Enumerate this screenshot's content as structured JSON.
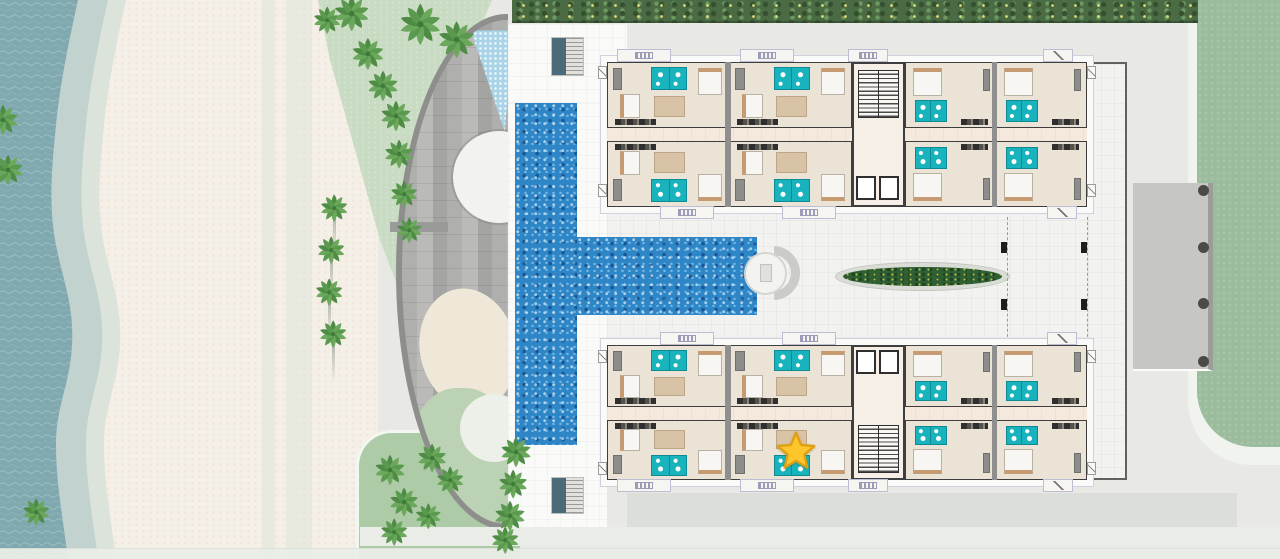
{
  "meta": {
    "description": "Aerial resort site / residential floor plan with beach, T-shaped pool, two apartment wings and a selected-unit star marker",
    "visible_text": []
  },
  "palette": {
    "ocean": "#7FA8AF",
    "foam": "#C2D2CE",
    "wet_sand": "#DCE3DB",
    "sand": "#F4EFE7",
    "lawn_pale": "#C9DCC3",
    "lawn_mid": "#AECBA8",
    "lawn_right": "#9CBD9D",
    "hedge": "#4A6B44",
    "paving": "#E8E9E5",
    "deck": "#FAFAF8",
    "courtyard": "#F2F2F0",
    "pool": "#2E86C6",
    "kids_pool": "#A9D4E8",
    "wall": "#3E3E3E",
    "unit_floor": "#EAE3D6",
    "corridor": "#F4E9DC",
    "bathroom_teal": "#18B3BC",
    "planter_green": "#2F5F33",
    "star_fill": "#FFC62B",
    "star_stroke": "#DFA012",
    "amenity_gray": "#AFAFAD"
  },
  "scene": {
    "beach": {
      "rect": [
        0,
        0,
        378,
        559
      ],
      "paths": [
        [
          262,
          0,
          13,
          559
        ],
        [
          286,
          0,
          26,
          559
        ]
      ]
    },
    "ocean": {
      "svg_w": 200,
      "wet": "M0,0 L126,0 C116,45 108,85 104,125 C100,165 96,205 104,245 C112,285 122,305 120,345 C118,385 104,405 104,445 C104,485 112,525 116,559 L0,559 Z",
      "foam": "M0,0 L108,0 C98,45 90,85 86,125 C82,165 78,205 86,245 C94,285 104,305 102,345 C100,385 86,405 86,445 C86,485 94,525 98,559 L0,559 Z",
      "water": "M0,0 L78,0 C68,45 60,85 56,125 C52,165 48,205 56,245 C64,285 74,305 72,345 C70,385 56,405 56,445 C56,485 64,525 68,559 L0,559 Z"
    },
    "lawn_top_left": {
      "rect": [
        300,
        0,
        210,
        300
      ],
      "clip": "polygon(18px 0px,192px 0px,180px 28px,145px 95px,120px 170px,105px 235px,99px 290px,80px 240px,55px 150px,30px 60px)"
    },
    "lawn_bottom_left": {
      "rect": [
        356,
        430,
        164,
        129
      ],
      "radius": "36px 0 0 0"
    },
    "lawn_right": {
      "outer": [
        1188,
        -40,
        132,
        505
      ],
      "outer_radius": "0 0 0 64px",
      "inner": [
        1197,
        -40,
        123,
        487
      ],
      "inner_radius": "0 0 0 56px"
    },
    "entry_pad": {
      "rect": [
        1133,
        183,
        80,
        188
      ],
      "dots": [
        [
          1198,
          185,
          11,
          11
        ],
        [
          1198,
          242,
          11,
          11
        ],
        [
          1198,
          298,
          11,
          11
        ],
        [
          1198,
          356,
          11,
          11
        ]
      ]
    },
    "hedge": {
      "rect": [
        512,
        0,
        686,
        23
      ]
    },
    "amenity": {
      "lens": [
        396,
        14,
        112,
        516
      ],
      "kids_pool": [
        66,
        6,
        46,
        108
      ],
      "shade_circle": [
        51,
        111,
        92,
        92
      ],
      "sand_patch": [
        18,
        268,
        96,
        122
      ],
      "green_patch": [
        6,
        368,
        106,
        148
      ],
      "pale_circle": [
        58,
        374,
        68,
        68
      ],
      "gray_bar": [
        390,
        222,
        58,
        10
      ]
    },
    "deck_rects": [
      [
        508,
        24,
        119,
        86
      ],
      [
        508,
        103,
        99,
        427
      ]
    ],
    "courtyard": {
      "rect": [
        607,
        62,
        520,
        418
      ],
      "dashes": [
        [
          1007,
          217,
          0,
          130
        ],
        [
          1087,
          217,
          0,
          130
        ]
      ],
      "columns": [
        [
          1001,
          242,
          6,
          11
        ],
        [
          1081,
          242,
          6,
          11
        ],
        [
          1001,
          299,
          6,
          11
        ],
        [
          1081,
          299,
          6,
          11
        ]
      ]
    },
    "bands": {
      "under_south_wing": [
        627,
        493,
        610,
        34
      ],
      "lower": [
        360,
        527,
        920,
        19
      ],
      "bottom_edge": [
        0,
        548,
        1280,
        11
      ]
    },
    "pool": {
      "vertical": [
        515,
        103,
        62,
        342
      ],
      "arm": [
        577,
        237,
        180,
        78
      ],
      "steps_ring": [
        746,
        246,
        54,
        54
      ],
      "steps_circle": [
        744,
        252,
        43,
        43
      ],
      "steps_handle": [
        760,
        264,
        12,
        18
      ]
    },
    "planter": {
      "rect": [
        835,
        262,
        175,
        29
      ]
    },
    "deck_stairs": [
      [
        551,
        37,
        33,
        39
      ],
      [
        551,
        477,
        33,
        37
      ]
    ],
    "wings": [
      {
        "id": "north-wing",
        "slab": [
          600,
          55,
          494,
          159
        ],
        "body": [
          607,
          62,
          480,
          145
        ],
        "corridor": [
          607,
          128,
          480,
          13
        ],
        "separators": [
          [
            725,
            62,
            6,
            145
          ],
          [
            992,
            62,
            5,
            145
          ]
        ],
        "core": {
          "rect": [
            852,
            62,
            53,
            145
          ],
          "stairs": [
            858,
            70,
            41,
            48
          ],
          "elevators": [
            [
              856,
              176,
              20,
              24
            ],
            [
              879,
              176,
              20,
              24
            ]
          ]
        },
        "units": [
          {
            "r": [
              607,
              62,
              122,
              66
            ],
            "t": "a",
            "fy": 0
          },
          {
            "r": [
              729,
              62,
              123,
              66
            ],
            "t": "a",
            "fy": 0
          },
          {
            "r": [
              905,
              62,
              91,
              66
            ],
            "t": "b",
            "fy": 0
          },
          {
            "r": [
              996,
              62,
              91,
              66
            ],
            "t": "b",
            "fy": 0
          },
          {
            "r": [
              607,
              141,
              122,
              66
            ],
            "t": "a",
            "fy": 1
          },
          {
            "r": [
              729,
              141,
              123,
              66
            ],
            "t": "a",
            "fy": 1
          },
          {
            "r": [
              905,
              141,
              91,
              66
            ],
            "t": "b",
            "fy": 1
          },
          {
            "r": [
              996,
              141,
              91,
              66
            ],
            "t": "b",
            "fy": 1
          }
        ],
        "balconies": [
          [
            617,
            49,
            54,
            13,
            "rail"
          ],
          [
            740,
            49,
            54,
            13,
            "rail"
          ],
          [
            848,
            49,
            40,
            13,
            "rail"
          ],
          [
            1043,
            49,
            30,
            13,
            "diag"
          ],
          [
            660,
            206,
            54,
            13,
            "rail"
          ],
          [
            782,
            206,
            54,
            13,
            "rail"
          ],
          [
            1047,
            206,
            30,
            13,
            "diag"
          ]
        ],
        "ac_units": [
          [
            598,
            66,
            9,
            13
          ],
          [
            598,
            184,
            9,
            13
          ],
          [
            1087,
            66,
            9,
            13
          ],
          [
            1087,
            184,
            9,
            13
          ]
        ]
      },
      {
        "id": "south-wing",
        "slab": [
          600,
          338,
          494,
          149
        ],
        "body": [
          607,
          345,
          480,
          135
        ],
        "corridor": [
          607,
          407,
          480,
          13
        ],
        "separators": [
          [
            725,
            345,
            6,
            135
          ],
          [
            992,
            345,
            5,
            135
          ]
        ],
        "core": {
          "rect": [
            852,
            345,
            53,
            135
          ],
          "stairs": [
            858,
            425,
            41,
            48
          ],
          "elevators": [
            [
              856,
              350,
              20,
              24
            ],
            [
              879,
              350,
              20,
              24
            ]
          ]
        },
        "units": [
          {
            "r": [
              607,
              345,
              122,
              62
            ],
            "t": "a",
            "fy": 0
          },
          {
            "r": [
              729,
              345,
              123,
              62
            ],
            "t": "a",
            "fy": 0
          },
          {
            "r": [
              905,
              345,
              91,
              62
            ],
            "t": "b",
            "fy": 0
          },
          {
            "r": [
              996,
              345,
              91,
              62
            ],
            "t": "b",
            "fy": 0
          },
          {
            "r": [
              607,
              420,
              122,
              60
            ],
            "t": "a",
            "fy": 1
          },
          {
            "r": [
              729,
              420,
              123,
              60
            ],
            "t": "a",
            "fy": 1
          },
          {
            "r": [
              905,
              420,
              91,
              60
            ],
            "t": "b",
            "fy": 1
          },
          {
            "r": [
              996,
              420,
              91,
              60
            ],
            "t": "b",
            "fy": 1
          }
        ],
        "balconies": [
          [
            660,
            332,
            54,
            13,
            "rail"
          ],
          [
            782,
            332,
            54,
            13,
            "rail"
          ],
          [
            1047,
            332,
            30,
            13,
            "diag"
          ],
          [
            617,
            479,
            54,
            13,
            "rail"
          ],
          [
            740,
            479,
            54,
            13,
            "rail"
          ],
          [
            848,
            479,
            40,
            13,
            "rail"
          ],
          [
            1043,
            479,
            30,
            13,
            "diag"
          ]
        ],
        "ac_units": [
          [
            598,
            350,
            9,
            13
          ],
          [
            598,
            462,
            9,
            13
          ],
          [
            1087,
            350,
            9,
            13
          ],
          [
            1087,
            462,
            9,
            13
          ]
        ]
      }
    ],
    "palms": [
      [
        3,
        120,
        1.0,
        0
      ],
      [
        8,
        170,
        1.0,
        0
      ],
      [
        327,
        20,
        0.9,
        0
      ],
      [
        352,
        14,
        1.15,
        0
      ],
      [
        420,
        24,
        1.35,
        0
      ],
      [
        457,
        40,
        1.2,
        0
      ],
      [
        368,
        54,
        1.05,
        0
      ],
      [
        383,
        86,
        1.0,
        0
      ],
      [
        396,
        116,
        1.0,
        0
      ],
      [
        399,
        154,
        0.95,
        0
      ],
      [
        404,
        194,
        0.9,
        0
      ],
      [
        409,
        230,
        0.85,
        0
      ],
      [
        334,
        208,
        0.9,
        1
      ],
      [
        331,
        250,
        0.9,
        1
      ],
      [
        329,
        292,
        0.9,
        1
      ],
      [
        333,
        334,
        0.9,
        1
      ],
      [
        36,
        512,
        0.9,
        0
      ],
      [
        390,
        470,
        1.0,
        0
      ],
      [
        404,
        502,
        0.95,
        0
      ],
      [
        432,
        458,
        0.95,
        0
      ],
      [
        450,
        480,
        0.9,
        0
      ],
      [
        394,
        532,
        0.9,
        0
      ],
      [
        428,
        516,
        0.85,
        0
      ],
      [
        516,
        452,
        1.0,
        0
      ],
      [
        513,
        484,
        0.95,
        0
      ],
      [
        510,
        516,
        1.0,
        0
      ],
      [
        505,
        540,
        0.9,
        0
      ]
    ],
    "star": {
      "x": 796,
      "y": 452,
      "size": 44
    }
  }
}
